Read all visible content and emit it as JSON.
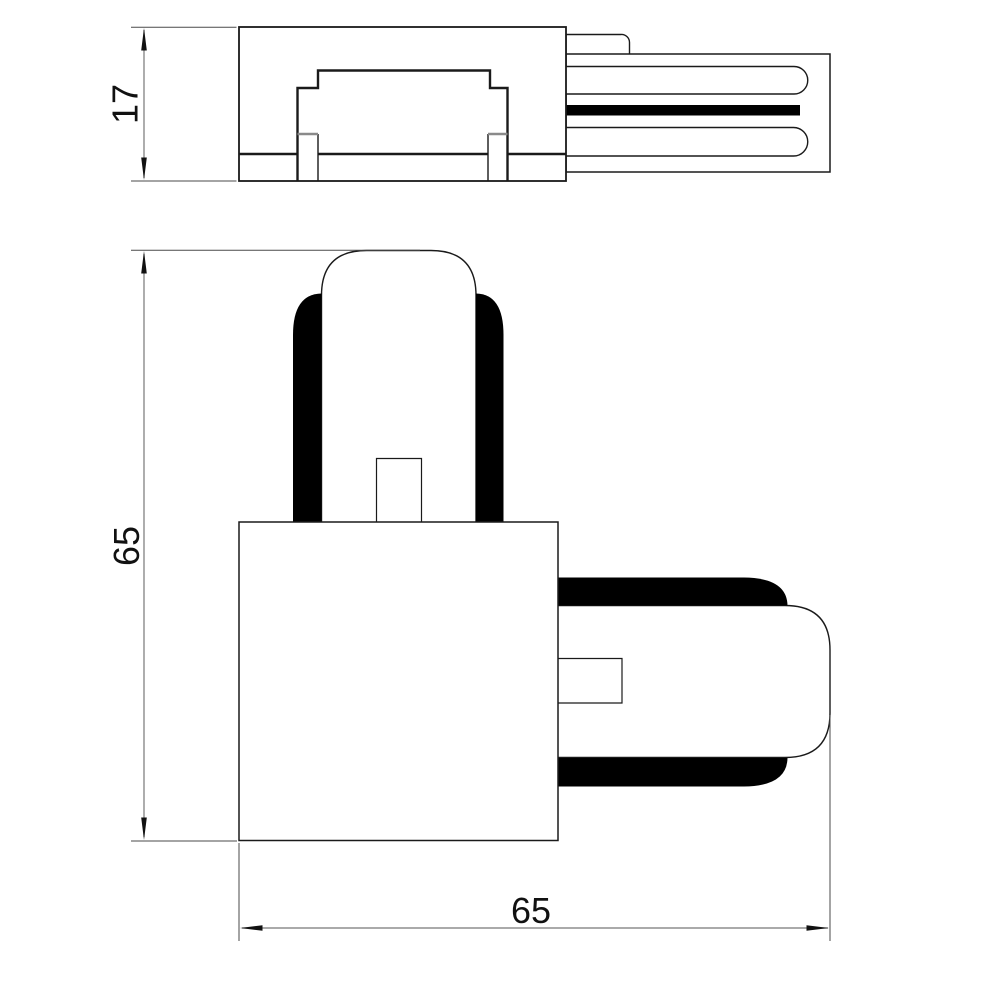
{
  "page": {
    "background": "#ffffff"
  },
  "colors": {
    "outline": "#1a1a1a",
    "solid_fill": "#000000",
    "dimension_line": "#777777",
    "extension_line": "#4a4a4a",
    "leg_cap_line": "#8a8a8a",
    "text": "#111111"
  },
  "dimensions": {
    "side_height_label": "17",
    "front_height_label": "65",
    "front_width_label": "65"
  }
}
